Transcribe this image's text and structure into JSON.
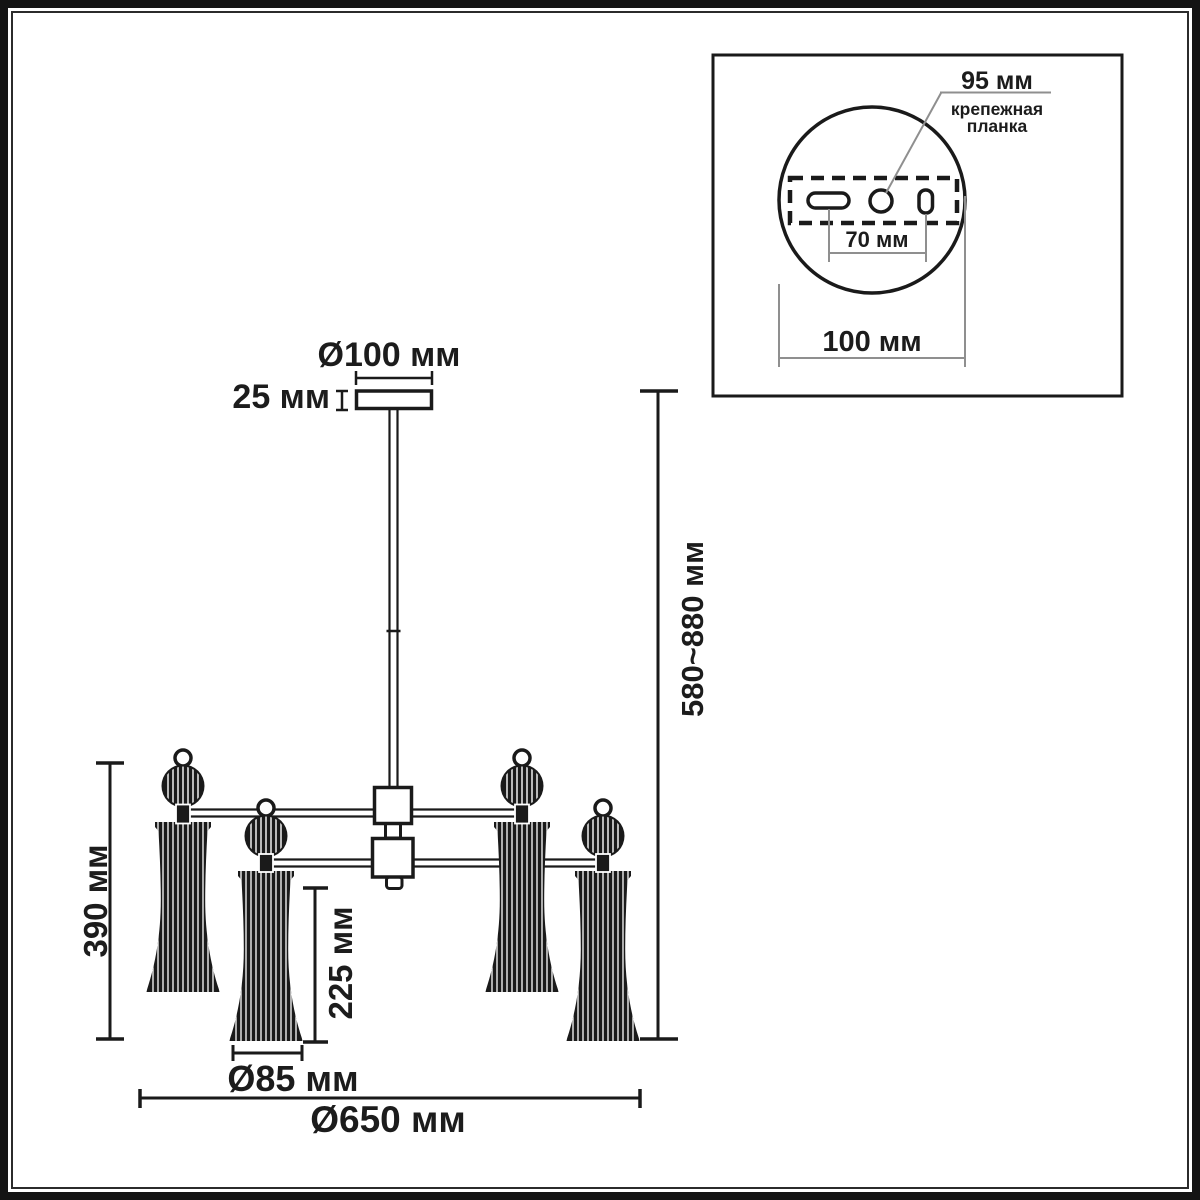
{
  "drawing": {
    "labels": {
      "canopy_diameter": "Ø100 мм",
      "canopy_height": "25 мм",
      "suspension_height": "580~880 мм",
      "fixture_height": "390 мм",
      "shade_height": "225 мм",
      "shade_diameter": "Ø85 мм",
      "overall_diameter": "Ø650 мм"
    }
  },
  "inset": {
    "labels": {
      "plate_width": "95 мм",
      "plate_caption_line1": "крепежная",
      "plate_caption_line2": "планка",
      "holes_spacing": "70 мм",
      "plate_diameter": "100 мм"
    }
  },
  "colors": {
    "line": "#1a1a1a",
    "helper_line": "#8f8f8f",
    "text": "#1c1c1c",
    "background": "#ffffff"
  }
}
